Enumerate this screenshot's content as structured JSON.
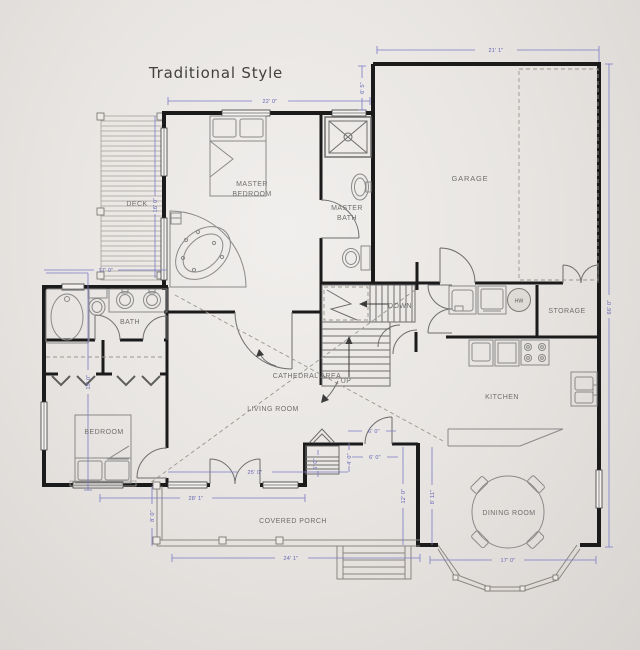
{
  "title": "Traditional Style",
  "rooms": {
    "deck": "DECK",
    "master_bedroom_1": "MASTER",
    "master_bedroom_2": "BEDROOM",
    "master_bath_1": "MASTER",
    "master_bath_2": "BATH",
    "garage": "GARAGE",
    "storage": "STORAGE",
    "kitchen": "KITCHEN",
    "dining_room": "DINING ROOM",
    "living_room": "LIVING ROOM",
    "cathedral_area": "CATHEDRAL AREA",
    "bath": "BATH",
    "bedroom": "BEDROOM",
    "covered_porch": "COVERED PORCH",
    "stairs_down": "DOWN",
    "stairs_up": "UP",
    "water_heater": "HW"
  },
  "dimensions": {
    "master_top": "22' 0\"",
    "garage_top": "21' 1\"",
    "garage_offset": "6' 5\"",
    "right_side": "66' 0\"",
    "left_side": "19' 0\"",
    "deck_height": "16' 0\"",
    "bath_top": "17' 0\"",
    "bedroom_bottom": "28' 1\"",
    "living_front": "25' 0\"",
    "porch_left": "8' 0\"",
    "porch_bottom": "24' 1\"",
    "bay_bottom": "17' 0\"",
    "porch_right": "12' 0\"",
    "dining_left": "8' 11\"",
    "nook_top": "6' 0\"",
    "nook_mid": "6' 0\"",
    "nook_side": "4' 0\"",
    "fireplace_side": "5' 0\""
  },
  "colors": {
    "background": "#e8e5e2",
    "wall": "#1b1b1b",
    "dimension": "#7b7bc4",
    "label": "#6f6f6f",
    "fixture": "#8a8a8a"
  }
}
